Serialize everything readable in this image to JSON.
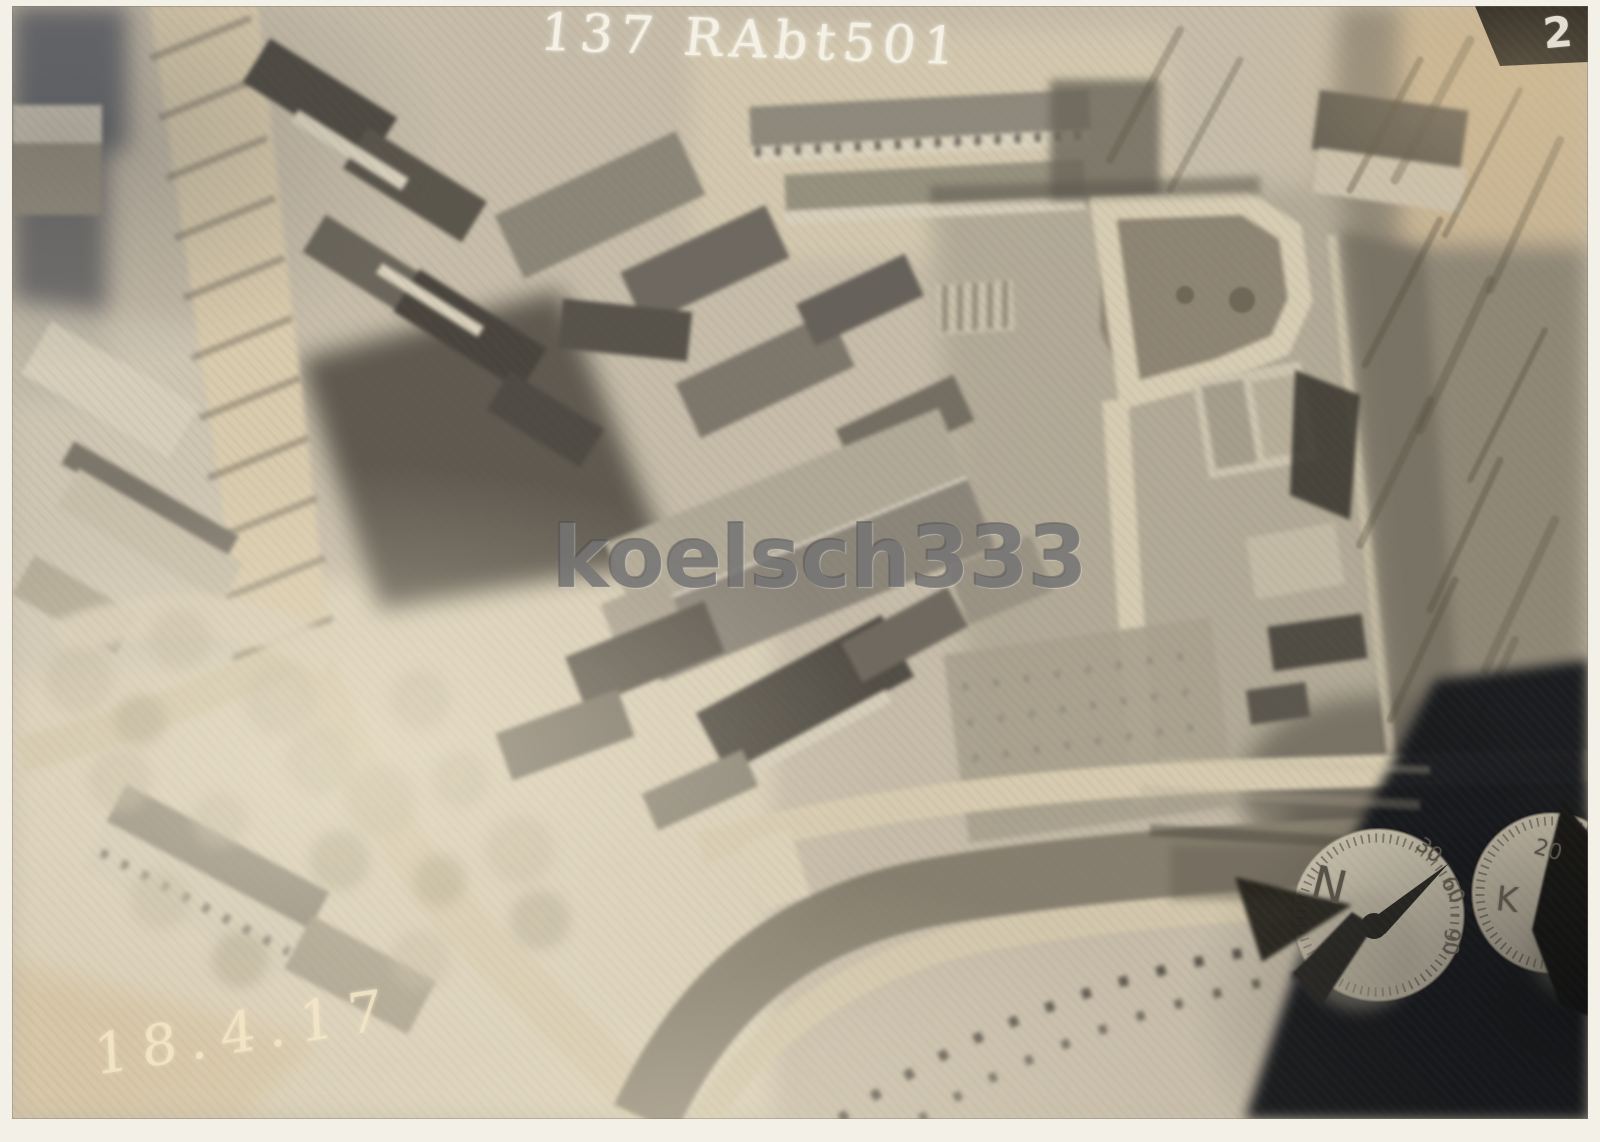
{
  "scan": {
    "annotation": "137 RAbt501",
    "watermark": "koelsch333",
    "date_inscription": "18.4.17",
    "plate_number": "2",
    "compass_dial": {
      "label": "N",
      "ticks": [
        "30",
        "60",
        "90"
      ]
    },
    "clock_dial": {
      "label": "K",
      "ticks": [
        "20"
      ]
    },
    "colors": {
      "paper_white": "#f3f0e8",
      "sepia_base": "#c6bca9",
      "sepia_light": "#d8cdb5",
      "roof_dark": "#4c483f",
      "woodland": "#8e8676",
      "corner_shadow": "#16181c",
      "dial_face": "#cdc5b1",
      "plate_wedge_black": "#0b0b0b"
    }
  }
}
